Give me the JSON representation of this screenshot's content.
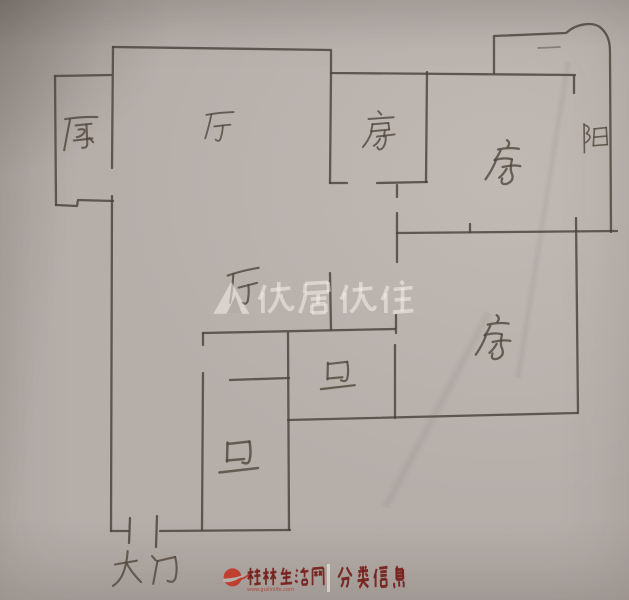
{
  "floor_plan": {
    "rooms": [
      {
        "key": "kitchen",
        "label": "厨"
      },
      {
        "key": "hall-upper",
        "label": "厅"
      },
      {
        "key": "bedroom-top-left",
        "label": "房"
      },
      {
        "key": "bedroom-top-right",
        "label": "房"
      },
      {
        "key": "balcony",
        "label": "阳"
      },
      {
        "key": "hall-lower",
        "label": "厅"
      },
      {
        "key": "bathroom-upper",
        "label": "卫"
      },
      {
        "key": "bedroom-bottom-right",
        "label": "房"
      },
      {
        "key": "bathroom-lower",
        "label": "卫"
      },
      {
        "key": "entrance",
        "label": "大门"
      }
    ]
  },
  "watermarks": {
    "center": {
      "logo": "youju-house-logo",
      "text": "优居优住"
    },
    "bottom": {
      "logo": "red-swoosh-logo",
      "site_name": "桂林生活网",
      "site_url": "www.guilinlife.com",
      "divider": "｜",
      "tagline": "分类信息"
    }
  },
  "colors": {
    "paper": "#b6aea9",
    "pencil": "#4a423b",
    "watermark_white": "rgba(245,241,233,0.55)",
    "watermark_red": "#76201b",
    "swoosh_red": "#c23a2a"
  }
}
